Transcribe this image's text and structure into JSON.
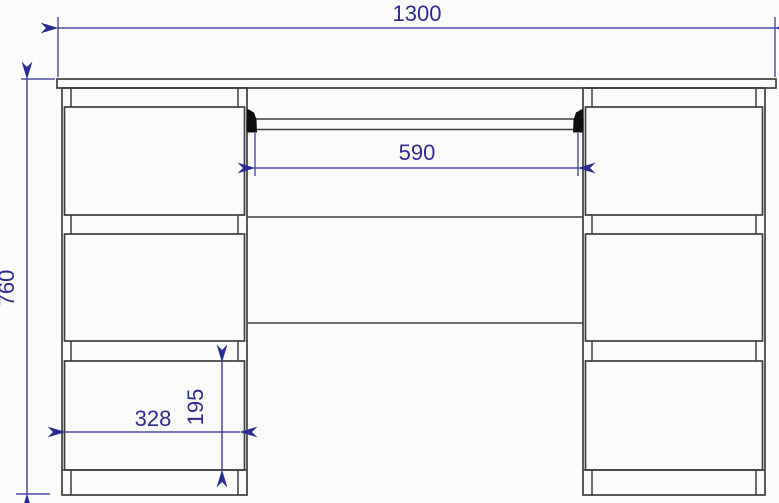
{
  "colors": {
    "background": "#fbfbfb",
    "outline": "#3e3e3e",
    "dimension": "#2b2b94",
    "bracket": "#101010"
  },
  "dimensions": {
    "overall_width": "1300",
    "overall_height": "760",
    "opening_width": "590",
    "drawer_width": "328",
    "drawer_height": "195"
  }
}
